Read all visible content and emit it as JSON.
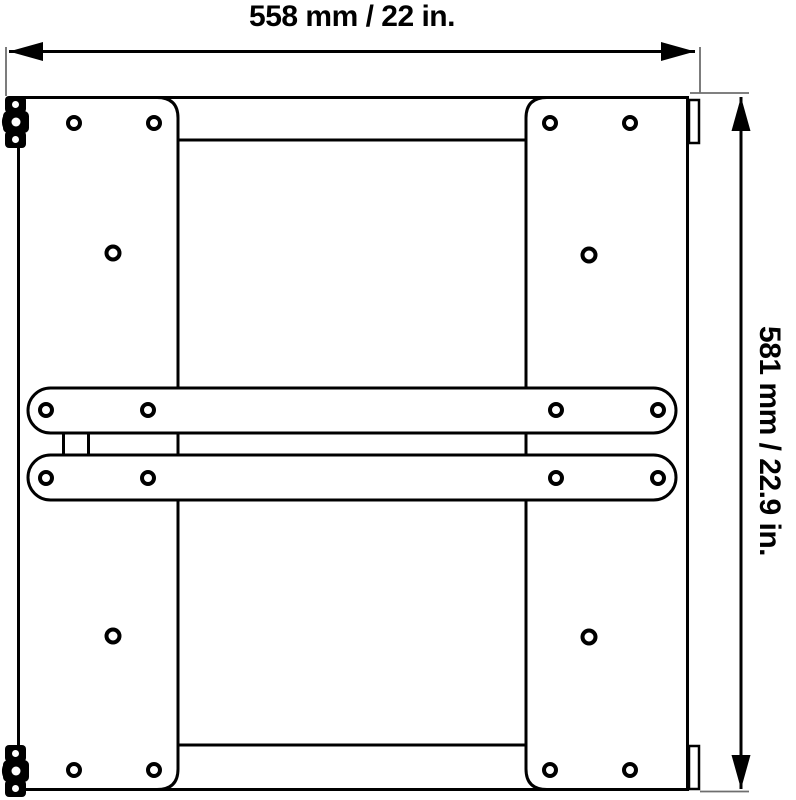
{
  "diagram": {
    "description": "Dimensioned black-and-white technical line drawing of a square mounting bracket frame (rear view) with two side mounting plates, two horizontal crossbars, screw holes, left hinge clamps and right edge tabs",
    "width_dimension_label": "558 mm / 22 in.",
    "height_dimension_label": "581 mm / 22.9 in.",
    "dimensions": {
      "width_mm": 558,
      "width_in": 22,
      "height_mm": 581,
      "height_in": 22.9
    },
    "colors": {
      "line": "#000000",
      "extension_line": "#6e6e6e",
      "background": "#ffffff"
    }
  }
}
